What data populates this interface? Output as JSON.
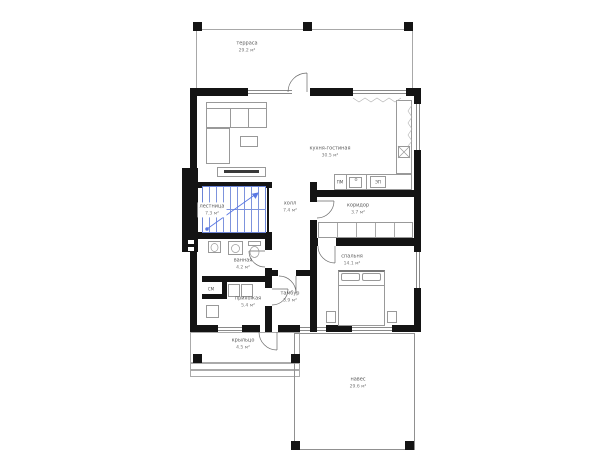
{
  "plan": {
    "unit": "м²",
    "rooms": {
      "terrace": {
        "name": "терраса",
        "area": "29.2 м²"
      },
      "kitchen_living": {
        "name": "кухня-гостиная",
        "area": "30.5 м²"
      },
      "stairs": {
        "name": "лестница",
        "area": "7.3 м²"
      },
      "hall": {
        "name": "холл",
        "area": "7.4 м²"
      },
      "corridor": {
        "name": "коридор",
        "area": "3.7 м²"
      },
      "bedroom": {
        "name": "спальня",
        "area": "14.1 м²"
      },
      "bathroom": {
        "name": "ванная",
        "area": "4.2 м²"
      },
      "entry_hall": {
        "name": "прихожая",
        "area": "5.4 м²"
      },
      "vestibule": {
        "name": "тамбур",
        "area": "3.9 м²"
      },
      "porch": {
        "name": "крыльцо",
        "area": "4.5 м²"
      },
      "canopy": {
        "name": "навес",
        "area": "29.6 м²"
      }
    },
    "appliances": {
      "dishwasher": "ПМ",
      "stove": "ЭП",
      "washer": "СМ"
    },
    "colors": {
      "wall": "#141414",
      "stairs": "#7d93dd",
      "furniture": "#999999",
      "background": "#ffffff"
    }
  }
}
